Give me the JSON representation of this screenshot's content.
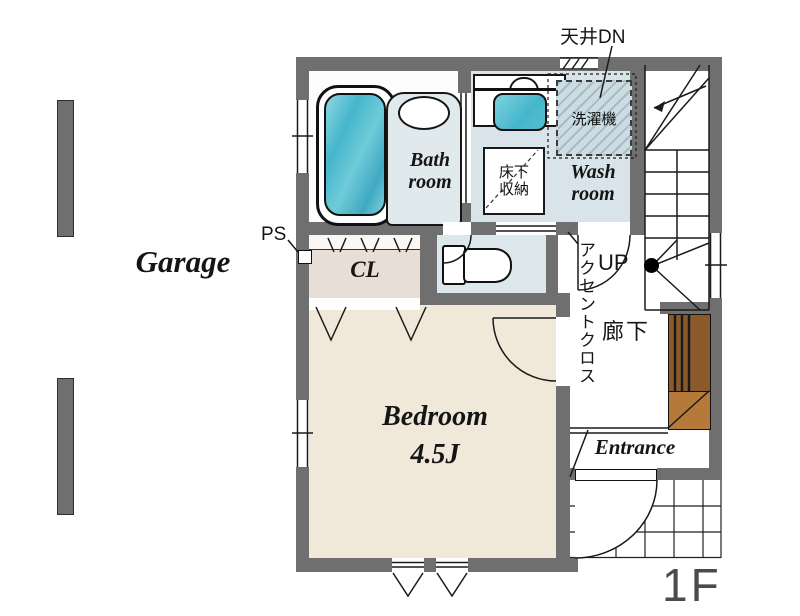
{
  "floor_label": "1F",
  "garage": {
    "label": "Garage"
  },
  "annotations": {
    "ceiling_dn": "天井DN",
    "ps": "PS",
    "up": "UP",
    "accent_cloth": "アクセントクロス"
  },
  "rooms": {
    "bathroom": {
      "line1": "Bath",
      "line2": "room"
    },
    "washroom": {
      "line1": "Wash",
      "line2": "room"
    },
    "washing_machine": {
      "label": "洗濯機"
    },
    "underfloor_storage": {
      "line1": "床下",
      "line2": "収納"
    },
    "closet": {
      "label": "CL"
    },
    "bedroom": {
      "name": "Bedroom",
      "size": "4.5J"
    },
    "hallway": {
      "label": "廊下"
    },
    "entrance": {
      "label": "Entrance"
    }
  },
  "colors": {
    "wall": "#6f6f6f",
    "tub_teal": "#45b6cc",
    "wet_floor": "#d8e4e9",
    "washplace": "#e0eaed",
    "wm_floor": "#ccdce3",
    "toilet_floor": "#dbe7ea",
    "closet_floor": "#e9ded6",
    "bedroom_floor": "#f0e9da",
    "cabinet_dark": "#8a5a2b",
    "cabinet_light": "#b5793a",
    "floor_label_gray": "#4b4b4b"
  }
}
